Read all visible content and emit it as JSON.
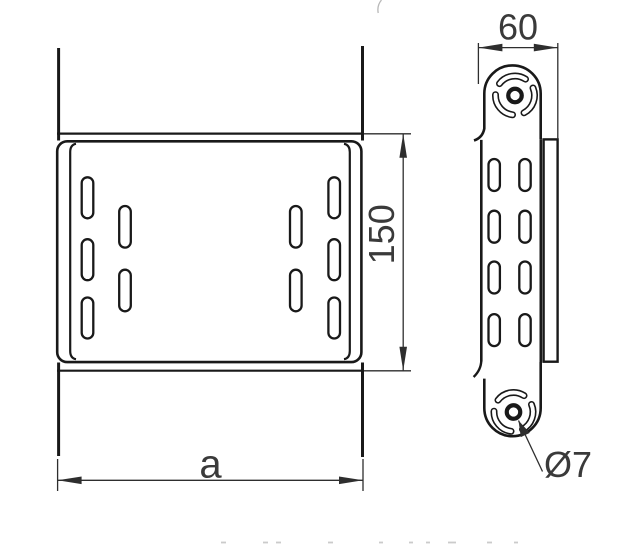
{
  "drawing": {
    "dimensions": {
      "width": "60",
      "height": "150",
      "length": "a",
      "hole": "Ø7"
    },
    "front_view": {
      "slot_count": 10
    },
    "side_view": {
      "slot_count": 8,
      "knockout_count": 2
    },
    "colors": {
      "line": "#191919",
      "dimension_line": "#2e2e2e",
      "dimension_text": "#3a3a3a",
      "background": "#ffffff"
    }
  }
}
